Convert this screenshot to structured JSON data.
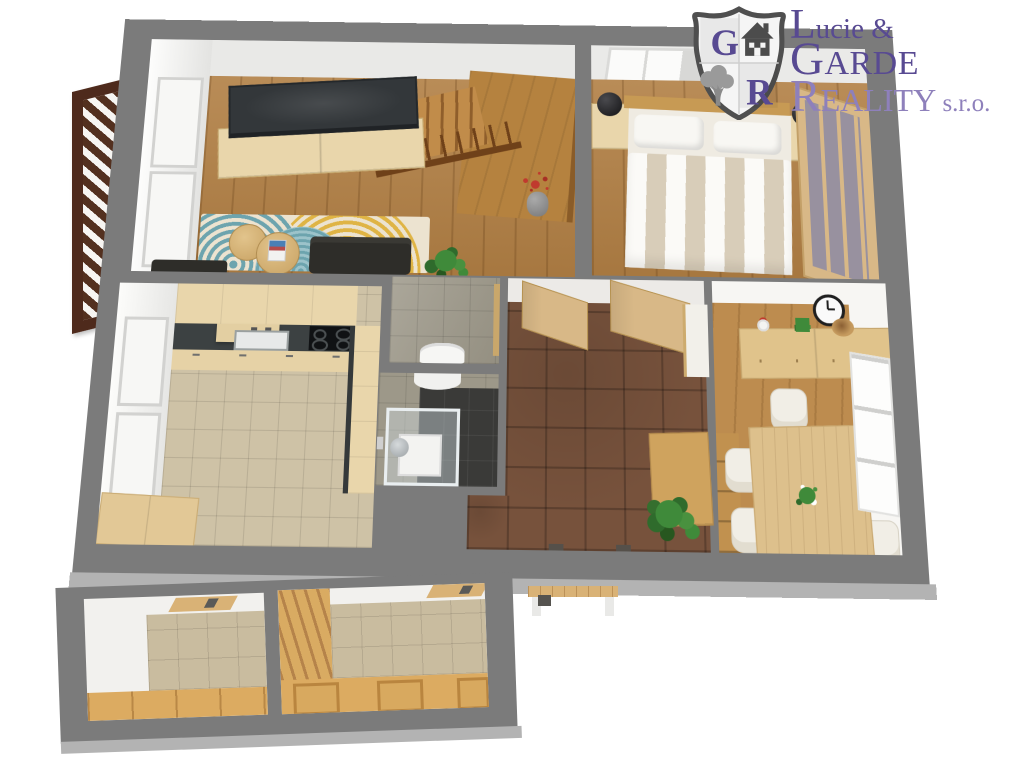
{
  "brand": {
    "shield_letter_top": "G",
    "shield_letter_bottom": "R",
    "name_line1": "Lucie &",
    "name_line2": "GARDE",
    "name_line3": "REALITY",
    "name_suffix": " s.r.o."
  },
  "palette": {
    "wall": "#7b7b7b",
    "wall-bevel": "#b3b3b3",
    "room-wall": "#ebebe9",
    "wood-floor": "#b17f44",
    "wood-floor-dining": "#bd8c4f",
    "wood-light": "#d8b887",
    "wood-cab": "#e9d6ab",
    "wood-mid": "#b5823f",
    "wood-dark-rail": "#6f4119",
    "counter-dark": "#3c4142",
    "cooktop": "#101214",
    "tile-beige": "#cec2a6",
    "tile-stairwell": "#c9bc9f",
    "tile-gray": "#9d9889",
    "tile-dark": "#3a3a38",
    "tile-brown": "#77523c",
    "sofa": "#2e2d29",
    "tv": "#33373a",
    "rug-base": "#ece3d0",
    "rug-teal": "#6da4ae",
    "rug-yellow": "#dfb445",
    "plant-green": "#3f8a3a",
    "plant-red": "#c03a2e",
    "balcony": "#4e2a1c",
    "logo-dark": "#584a92",
    "logo-light": "#8e80bb",
    "shield-outline": "#4f4f4f",
    "shield-fill": "#f5f5f5",
    "shield-icon": "#4c4c4c",
    "shield-tree": "#9a9a9a"
  },
  "scene": {
    "type": "3d-floor-plan-top-view",
    "rooms": [
      {
        "id": "living-room",
        "furniture": [
          "tv",
          "tv-cabinet",
          "staircase-with-railing",
          "rug",
          "coffee-tables",
          "sofa",
          "red-plant",
          "green-plant",
          "windows"
        ]
      },
      {
        "id": "bedroom",
        "furniture": [
          "double-bed",
          "striped-duvet",
          "pillows",
          "nightstands",
          "bedside-lamps",
          "sliding-wardrobe",
          "window"
        ]
      },
      {
        "id": "kitchen",
        "furniture": [
          "upper-cabinets",
          "dark-countertop",
          "sink",
          "cooktop",
          "base-cabinets",
          "low-cabinet",
          "windows",
          "tiled-floor"
        ]
      },
      {
        "id": "wc",
        "furniture": [
          "toilet",
          "gray-tiles"
        ]
      },
      {
        "id": "bathroom",
        "furniture": [
          "glass-shower",
          "sink",
          "dark-tiles"
        ]
      },
      {
        "id": "hallway",
        "furniture": [
          "open-doors",
          "white-cabinet",
          "wood-chest",
          "green-plant",
          "brown-tile-floor"
        ]
      },
      {
        "id": "dining-room",
        "furniture": [
          "dining-table",
          "six-chairs",
          "sideboard",
          "wall-clock",
          "wall-shelves",
          "flower-centerpiece"
        ]
      },
      {
        "id": "stairwell-left",
        "furniture": [
          "tiled-floor",
          "wood-parapet",
          "coat-shelf"
        ]
      },
      {
        "id": "stairwell-right",
        "furniture": [
          "building-staircase",
          "tiled-floor",
          "door-frames"
        ]
      },
      {
        "id": "balcony",
        "furniture": [
          "dark-wood-slat-railing"
        ]
      }
    ]
  }
}
